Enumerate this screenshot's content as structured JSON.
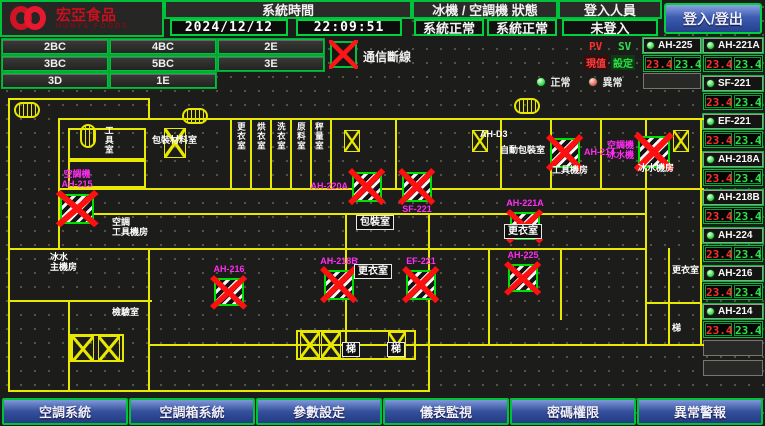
{
  "header": {
    "logo": {
      "title": "宏亞食品",
      "subtitle": "HUNYA FOODS"
    },
    "system_time": {
      "label": "系統時間",
      "date": "2024/12/12",
      "time": "22:09:51"
    },
    "machine_status": {
      "label": "冰機 / 空調機 狀態",
      "chiller_status": "系統正常",
      "ac_status": "系統正常"
    },
    "login": {
      "label": "登入人員",
      "status": "未登入",
      "button_label": "登入/登出"
    }
  },
  "floor_buttons": [
    "2BC",
    "4BC",
    "2E",
    "3BC",
    "5BC",
    "3E",
    "3D",
    "1E"
  ],
  "legend": {
    "comm_fault": "通信斷線",
    "normal": "正常",
    "abnormal": "異常",
    "pv": "PV",
    "sv": "SV",
    "pv_name": "現值",
    "sv_name": "設定"
  },
  "units_col_a": [
    {
      "name": "AH-225",
      "pv": "23.4",
      "sv": "23.4"
    }
  ],
  "units_col_b": [
    {
      "name": "AH-221A",
      "pv": "23.4",
      "sv": "23.4"
    },
    {
      "name": "SF-221",
      "pv": "23.4",
      "sv": "23.4"
    },
    {
      "name": "EF-221",
      "pv": "23.4",
      "sv": "23.4"
    },
    {
      "name": "AH-218A",
      "pv": "23.4",
      "sv": "23.4"
    },
    {
      "name": "AH-218B",
      "pv": "23.4",
      "sv": "23.4"
    },
    {
      "name": "AH-224",
      "pv": "23.4",
      "sv": "23.4"
    },
    {
      "name": "AH-216",
      "pv": "23.4",
      "sv": "23.4"
    },
    {
      "name": "AH-214",
      "pv": "23.4",
      "sv": "23.4"
    }
  ],
  "map": {
    "markers": [
      {
        "label": "空調機\nAH-215",
        "x": 60,
        "y": 194,
        "w": 34,
        "h": 30,
        "pos": "above"
      },
      {
        "label": "AH-220A",
        "x": 352,
        "y": 172,
        "w": 30,
        "h": 30,
        "pos": "left"
      },
      {
        "label": "SF-221",
        "x": 402,
        "y": 172,
        "w": 30,
        "h": 30,
        "pos": "below"
      },
      {
        "label": "AH-214",
        "x": 550,
        "y": 138,
        "w": 30,
        "h": 30,
        "pos": "right"
      },
      {
        "label": "空調機\n冰水機",
        "x": 638,
        "y": 136,
        "w": 32,
        "h": 32,
        "pos": "left"
      },
      {
        "label": "AH-216",
        "x": 214,
        "y": 278,
        "w": 30,
        "h": 28,
        "pos": "above"
      },
      {
        "label": "AH-218B",
        "x": 324,
        "y": 270,
        "w": 30,
        "h": 30,
        "pos": "above"
      },
      {
        "label": "EF-221",
        "x": 406,
        "y": 270,
        "w": 30,
        "h": 30,
        "pos": "above"
      },
      {
        "label": "AH-221A",
        "x": 510,
        "y": 212,
        "w": 30,
        "h": 28,
        "pos": "above"
      },
      {
        "label": "AH-225",
        "x": 508,
        "y": 264,
        "w": 30,
        "h": 28,
        "pos": "above"
      }
    ],
    "room_labels": [
      {
        "text": "工具室",
        "x": 104,
        "y": 126,
        "style": "v"
      },
      {
        "text": "包裝材料室",
        "x": 152,
        "y": 136,
        "style": "p"
      },
      {
        "text": "更衣室",
        "x": 236,
        "y": 122,
        "style": "v"
      },
      {
        "text": "烘衣室",
        "x": 256,
        "y": 122,
        "style": "v"
      },
      {
        "text": "洗衣室",
        "x": 276,
        "y": 122,
        "style": "v"
      },
      {
        "text": "原料室",
        "x": 296,
        "y": 122,
        "style": "v"
      },
      {
        "text": "秤量室",
        "x": 314,
        "y": 122,
        "style": "v"
      },
      {
        "text": "AH-D3",
        "x": 480,
        "y": 130,
        "style": "p"
      },
      {
        "text": "自動包裝室",
        "x": 500,
        "y": 146,
        "style": "p"
      },
      {
        "text": "工具機房",
        "x": 552,
        "y": 166,
        "style": "p"
      },
      {
        "text": "冰水機房",
        "x": 638,
        "y": 164,
        "style": "p"
      },
      {
        "text": "空調\n工具機房",
        "x": 112,
        "y": 218,
        "style": "p"
      },
      {
        "text": "冰水\n主機房",
        "x": 50,
        "y": 253,
        "style": "p"
      },
      {
        "text": "檢驗室",
        "x": 112,
        "y": 308,
        "style": "p"
      },
      {
        "text": "包裝室",
        "x": 356,
        "y": 215,
        "style": "b"
      },
      {
        "text": "更衣室",
        "x": 504,
        "y": 224,
        "style": "b"
      },
      {
        "text": "更衣室",
        "x": 354,
        "y": 264,
        "style": "b"
      },
      {
        "text": "更衣室",
        "x": 672,
        "y": 266,
        "style": "p"
      },
      {
        "text": "梯",
        "x": 672,
        "y": 324,
        "style": "p"
      },
      {
        "text": "梯",
        "x": 342,
        "y": 342,
        "style": "b"
      },
      {
        "text": "梯",
        "x": 387,
        "y": 342,
        "style": "b"
      }
    ]
  },
  "nav_buttons": [
    "空調系統",
    "空調箱系統",
    "參數設定",
    "儀表監視",
    "密碼權限",
    "異常警報"
  ],
  "colors": {
    "accent_green": "#00c23a",
    "alarm_red": "#ff2d2d",
    "setpoint_green": "#2de04a",
    "label_magenta": "#ff2cf2",
    "wall_yellow": "#e8e800",
    "nav_blue": "#35509c"
  }
}
